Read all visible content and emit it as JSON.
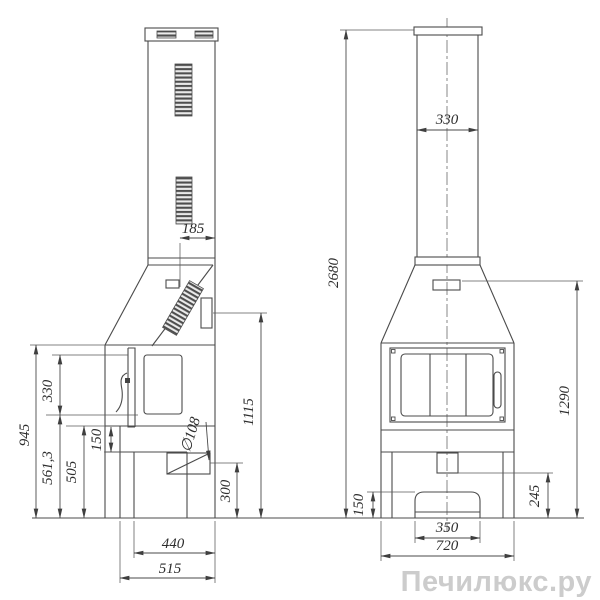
{
  "watermark": "Печилюкс.ру",
  "dims": {
    "side": {
      "offset185": "185",
      "height945": "945",
      "door330": "330",
      "lower5613": "561,3",
      "base505": "505",
      "hearth150": "150",
      "flue108": "∅108",
      "axis300": "300",
      "damper1115": "1115",
      "depth440": "440",
      "depth515": "515"
    },
    "front": {
      "pipe330": "330",
      "total2680": "2680",
      "hood1290": "1290",
      "outlet245": "245",
      "ash150": "150",
      "ash350": "350",
      "width720": "720"
    }
  }
}
